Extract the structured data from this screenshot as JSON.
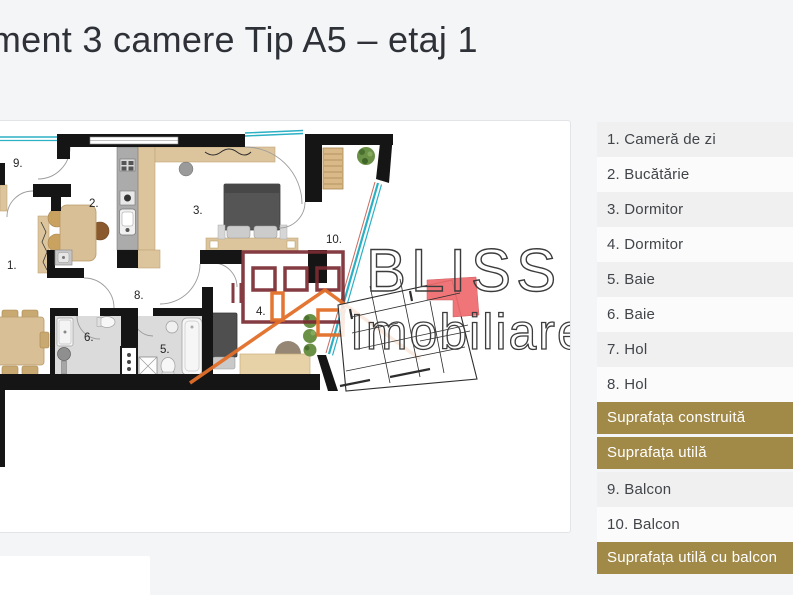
{
  "title": "Apartament 3 camere Tip A5 – etaj 1",
  "floorplan": {
    "brand_line1": "BLISS",
    "brand_line2": "Imobiliare",
    "labels": {
      "living": "1.",
      "kitchen": "2.",
      "bedroom_a": "3.",
      "bedroom_b": "4.",
      "bath_a": "5.",
      "bath_b": "6.",
      "hall": "8.",
      "balcony_a": "9.",
      "balcony_b": "10."
    }
  },
  "legend": {
    "rows": [
      {
        "label": "1. Cameră de zi",
        "type": "room"
      },
      {
        "label": "2. Bucătărie",
        "type": "room"
      },
      {
        "label": "3. Dormitor",
        "type": "room"
      },
      {
        "label": "4. Dormitor",
        "type": "room"
      },
      {
        "label": "5. Baie",
        "type": "room"
      },
      {
        "label": "6. Baie",
        "type": "room"
      },
      {
        "label": "7. Hol",
        "type": "room"
      },
      {
        "label": "8. Hol",
        "type": "room"
      },
      {
        "label": "Suprafața construită",
        "type": "summary"
      },
      {
        "label": "Suprafața utilă",
        "type": "summary"
      },
      {
        "label": "9. Balcon",
        "type": "room"
      },
      {
        "label": "10. Balcon",
        "type": "room"
      },
      {
        "label": "Suprafața utilă cu balcon",
        "type": "summary"
      }
    ]
  },
  "colors": {
    "accent_gold": "#a18947",
    "row_alt_bg": "#f0f0f0",
    "teal_rail": "#2bb0c4",
    "watermark_maroon": "#7b2b33",
    "watermark_orange": "#e26f29",
    "keyplan_red": "#ee6a6d"
  }
}
